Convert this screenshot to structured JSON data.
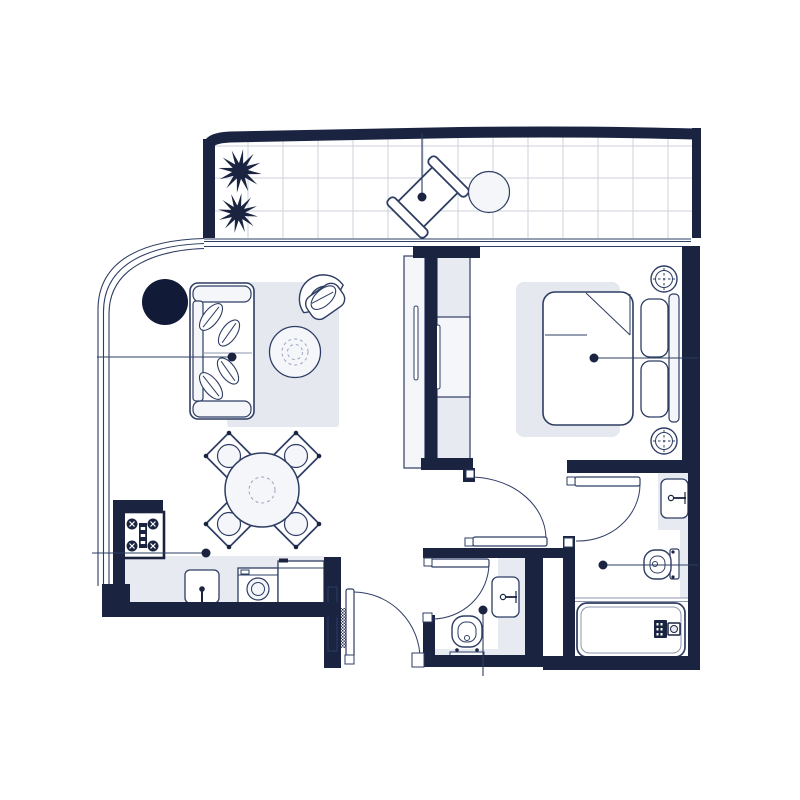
{
  "meta": {
    "title": "Apartment floor plan",
    "type": "floor-plan",
    "canvas": {
      "width": 800,
      "height": 800
    },
    "visible_text": "none"
  },
  "colors": {
    "bg": "#ffffff",
    "wall": "#1a2441",
    "outline": "#2e3d63",
    "mid": "#8b95ae",
    "light": "#e8eaf1",
    "lighter": "#f5f6fa",
    "rug": "#e5e8ef",
    "white": "#ffffff",
    "dash": "#9aa4bd",
    "tileline": "#ccd2de",
    "dark_accent": "#111a36"
  },
  "rooms": [
    {
      "id": "balcony",
      "features": [
        "tiled-floor",
        "plants",
        "sun-lounger",
        "round-table",
        "sliding-glass-doors"
      ]
    },
    {
      "id": "living-room",
      "features": [
        "sofa",
        "leaf-cushions",
        "rug",
        "coffee-table",
        "armchair",
        "side-table",
        "curved-glass-wall"
      ]
    },
    {
      "id": "dining-area",
      "features": [
        "round-dining-table",
        "four-chairs"
      ]
    },
    {
      "id": "kitchen",
      "features": [
        "gas-stove",
        "counter",
        "sink",
        "washing-machine",
        "refrigerator"
      ]
    },
    {
      "id": "bedroom",
      "features": [
        "double-bed",
        "folded-blanket",
        "two-pillows",
        "headboard",
        "two-bedside-lamps",
        "rug",
        "wardrobe-closets"
      ]
    },
    {
      "id": "hallway",
      "features": [
        "entry-door",
        "bedroom-door"
      ]
    },
    {
      "id": "bathroom",
      "features": [
        "bathtub",
        "toilet",
        "vanity-sink",
        "shower-screen",
        "door"
      ]
    },
    {
      "id": "wc",
      "features": [
        "toilet",
        "vanity-sink",
        "door"
      ]
    }
  ],
  "hotspots": [
    {
      "id": "marker-lounger",
      "marker_for": "sun-lounger"
    },
    {
      "id": "marker-sofa",
      "marker_for": "sofa"
    },
    {
      "id": "marker-bed",
      "marker_for": "double-bed"
    },
    {
      "id": "marker-stove",
      "marker_for": "gas-stove"
    },
    {
      "id": "marker-wc",
      "marker_for": "wc-toilet"
    },
    {
      "id": "marker-bathroom",
      "marker_for": "bathroom-toilet"
    }
  ]
}
